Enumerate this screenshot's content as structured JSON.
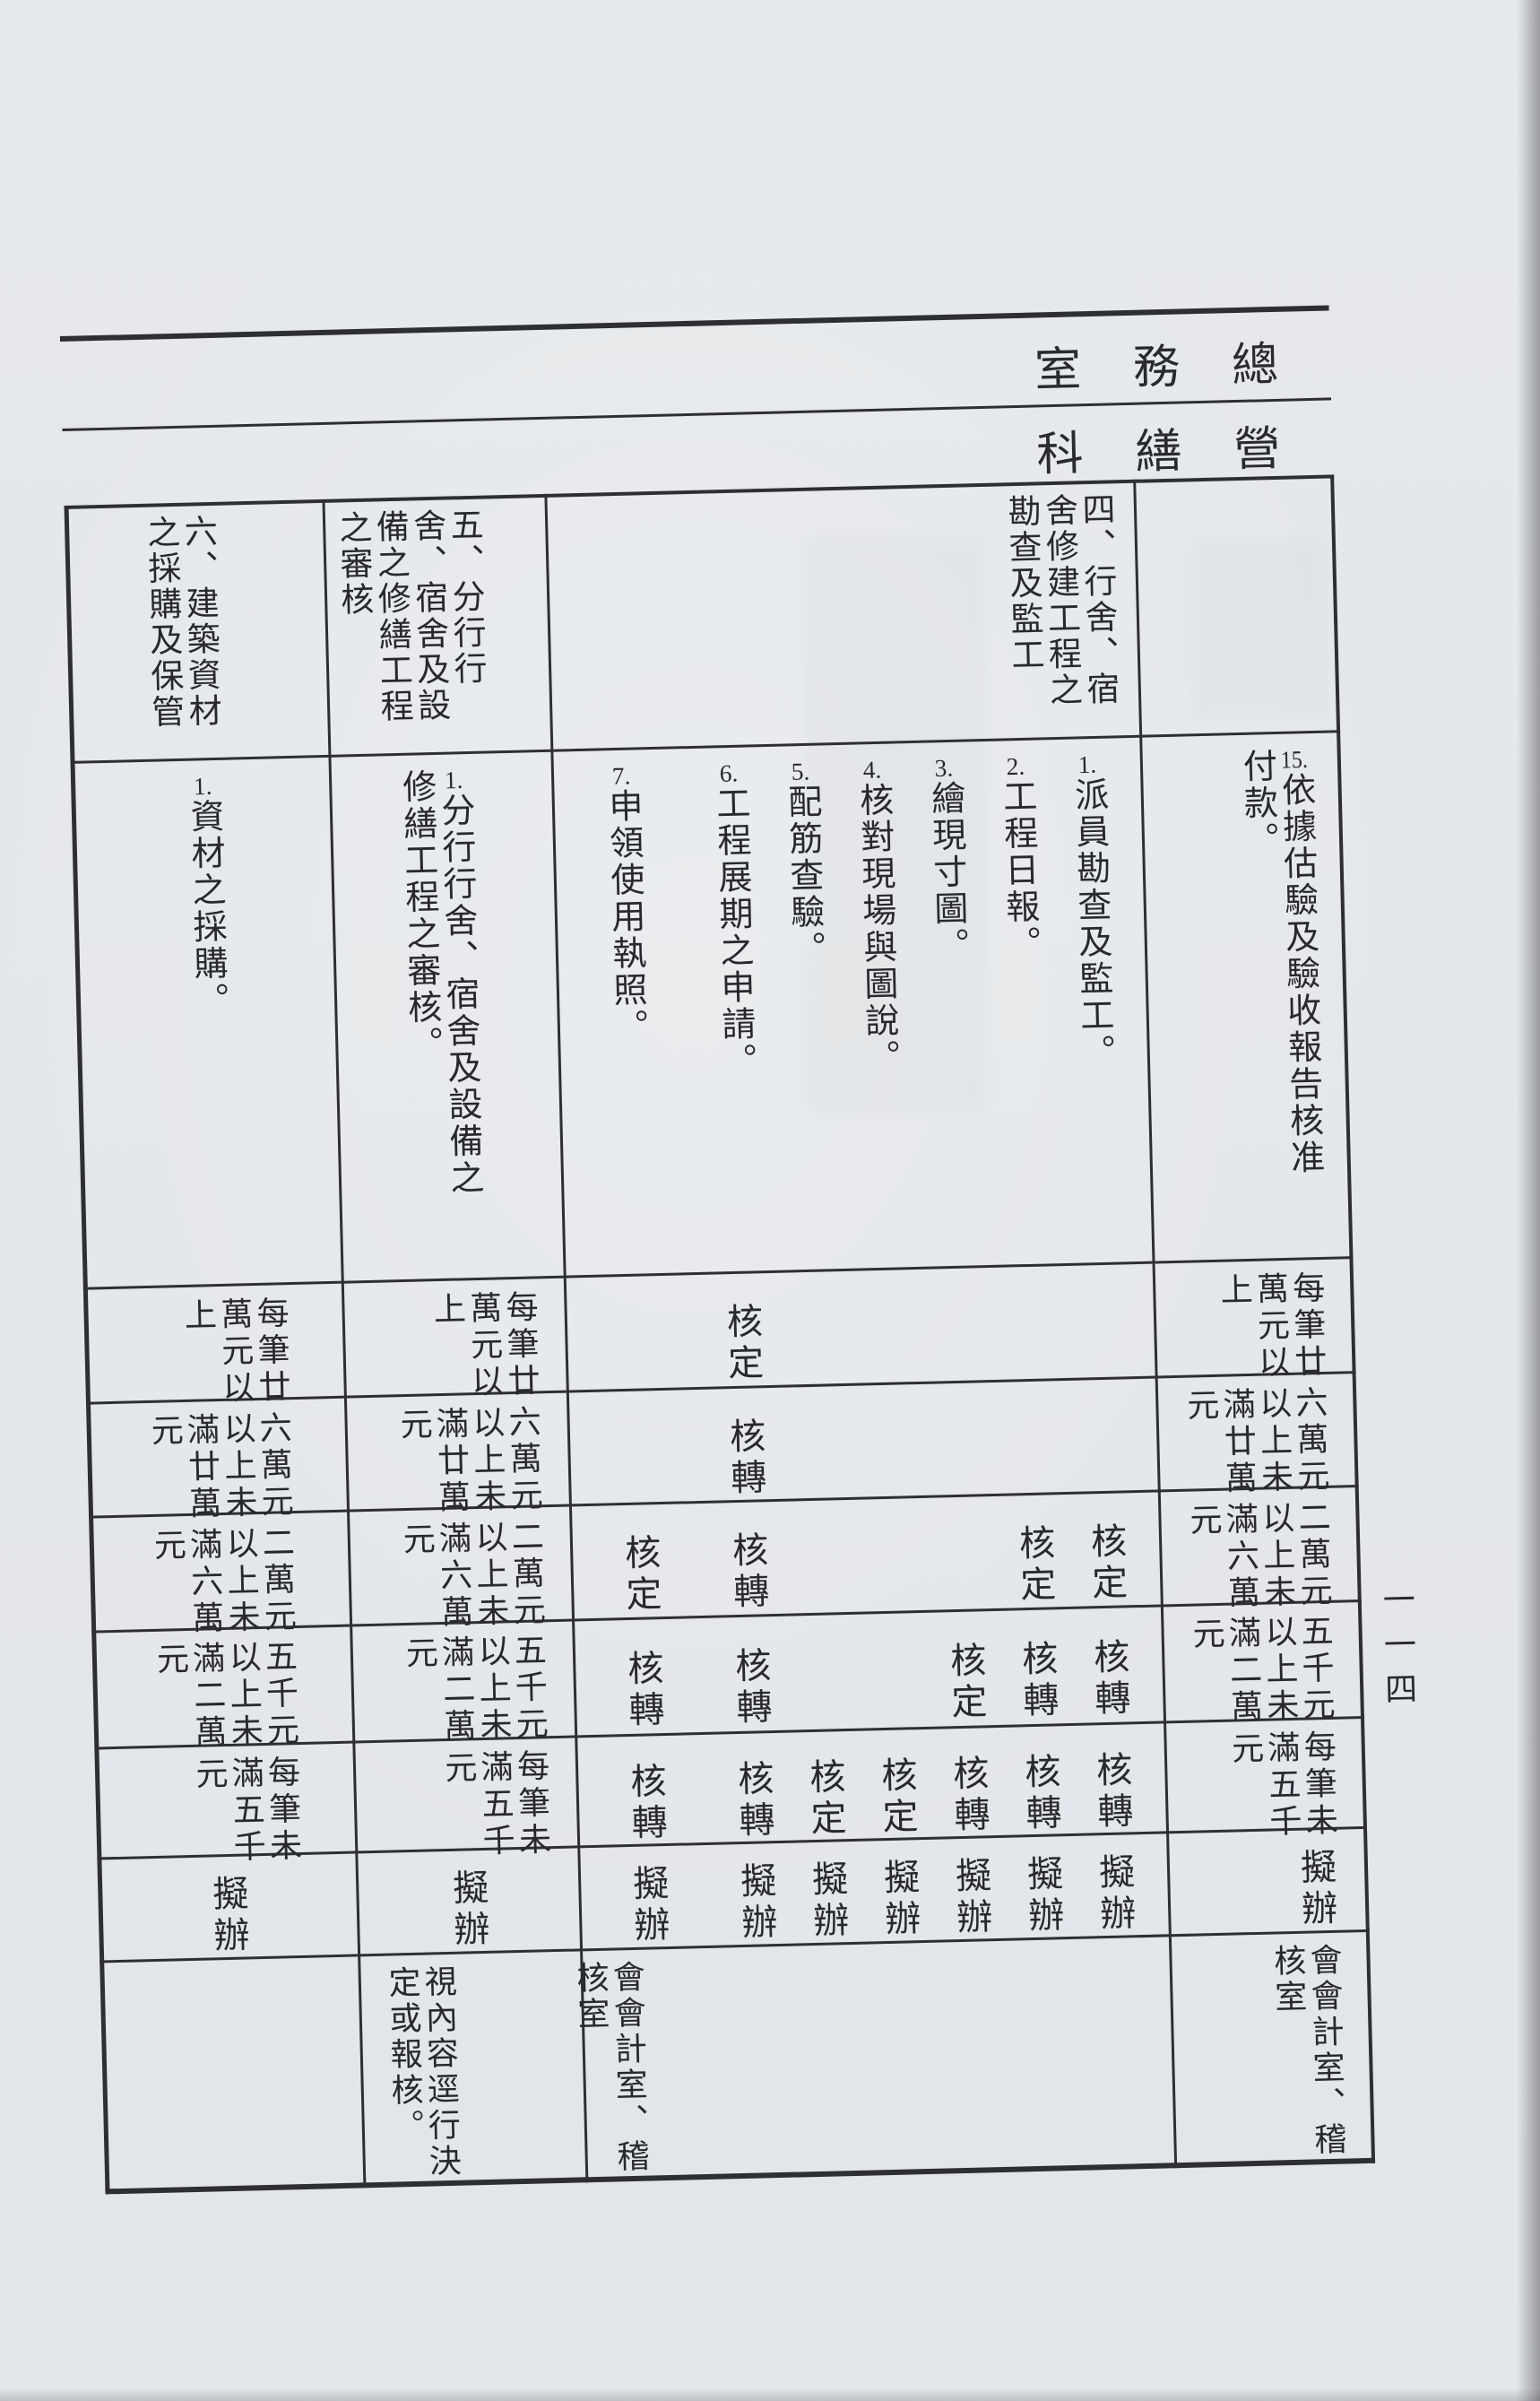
{
  "page": {
    "number": "一一四"
  },
  "corner": {
    "row1": "室務總",
    "row2": "科繕營"
  },
  "table": {
    "items": {
      "item4": {
        "title": "四、行舍、宿舍修建工程之勘查及監工",
        "tasks": [
          {
            "num": "1.",
            "text": "派員勘查及監工。"
          },
          {
            "num": "2.",
            "text": "工程日報。"
          },
          {
            "num": "3.",
            "text": "繪現寸圖。"
          },
          {
            "num": "4.",
            "text": "核對現場與圖說。"
          },
          {
            "num": "5.",
            "text": "配筋查驗。"
          },
          {
            "num": "6.",
            "text": "工程展期之申請。"
          },
          {
            "num": "7.",
            "text": "申領使用執照。"
          }
        ],
        "remark": "會會計室、稽核室"
      },
      "item5": {
        "title": "五、分行行舍、宿舍及設備之修繕工程之審核",
        "task": {
          "num": "1.",
          "text": "分行行舍、宿舍及設備之修繕工程之審核。"
        },
        "remark": "視內容逕行決定或報核。"
      },
      "item6": {
        "title": "六、建築資材之採購及保管",
        "task": {
          "num": "1.",
          "text": "資材之採購。"
        }
      },
      "cont": {
        "task": {
          "num": "15.",
          "text": "依據估驗及驗收報告核准付款。"
        },
        "remark": "會會計室、稽核室"
      }
    },
    "amounts": [
      "每筆廿萬元以上",
      "六萬元以上未滿廿萬元",
      "二萬元以上未滿六萬元",
      "五千元以上未滿二萬元",
      "每筆未滿五千元"
    ],
    "marks": {
      "draft": "擬辦"
    },
    "grid": {
      "b1": {
        "t6": "核定"
      },
      "b2": {
        "t6": "核轉"
      },
      "b3": {
        "t7": "核定",
        "t6": "核轉",
        "t2": "核定",
        "t1": "核定"
      },
      "b4": {
        "t7": "核轉",
        "t6": "核轉",
        "t3": "核定",
        "t2": "核轉",
        "t1": "核轉"
      },
      "b5": {
        "t7": "核轉",
        "t6": "核轉",
        "t5": "核定",
        "t4": "核定",
        "t3": "核轉",
        "t2": "核轉",
        "t1": "核轉"
      }
    }
  }
}
